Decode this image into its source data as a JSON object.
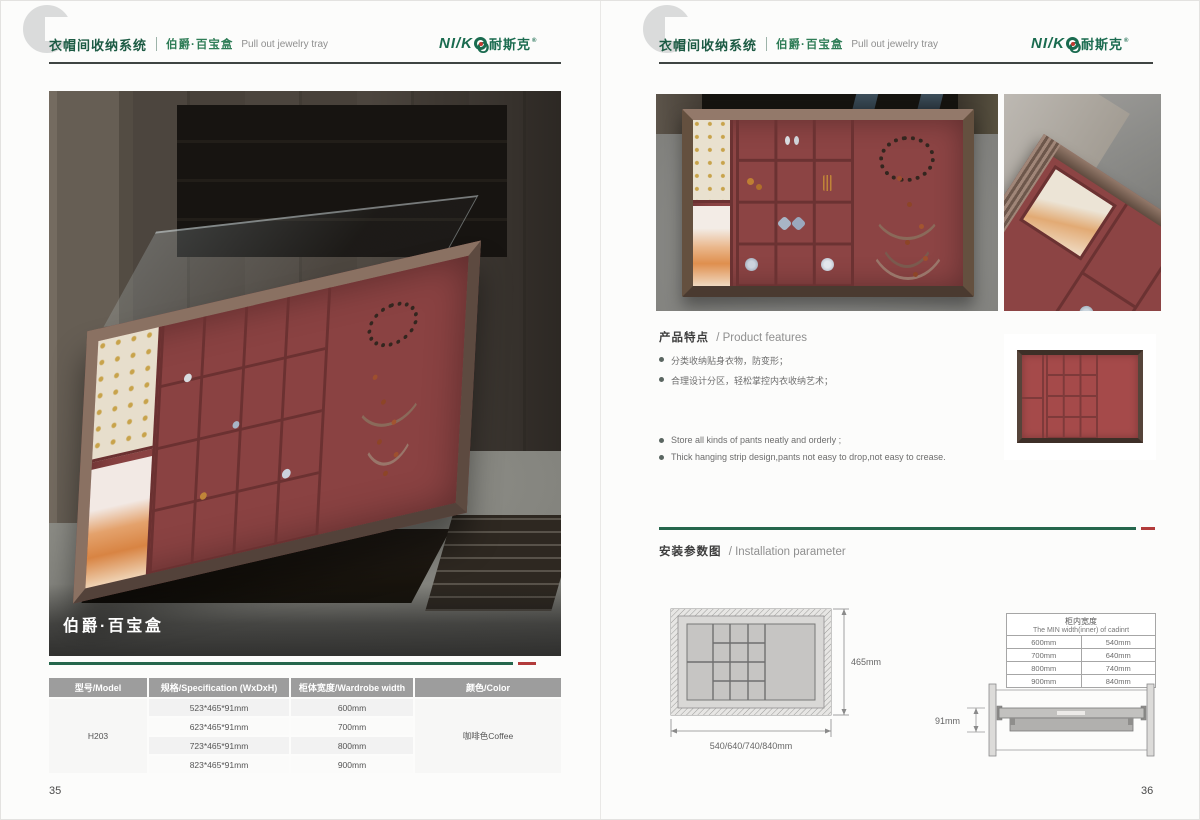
{
  "brand": {
    "logo_prefix": "NI/K",
    "logo_o": "O",
    "logo_suffix": "耐斯克",
    "logo_reg": "®",
    "green": "#1a6b4f",
    "red": "#b23b3b"
  },
  "header": {
    "watermark_letter": "C",
    "system_title": "衣帽间收纳系统",
    "series_name": "伯爵·百宝盒",
    "series_name_en": "Pull out jewelry tray"
  },
  "left_page": {
    "photo_title": "伯爵·百宝盒",
    "page_number": "35",
    "table": {
      "headers": [
        "型号/Model",
        "规格/Specification (WxDxH)",
        "柜体宽度/Wardrobe width",
        "颜色/Color"
      ],
      "model": "H203",
      "color": "咖啡色Coffee",
      "rows": [
        {
          "spec": "523*465*91mm",
          "width": "600mm"
        },
        {
          "spec": "623*465*91mm",
          "width": "700mm"
        },
        {
          "spec": "723*465*91mm",
          "width": "800mm"
        },
        {
          "spec": "823*465*91mm",
          "width": "900mm"
        }
      ]
    }
  },
  "right_page": {
    "page_number": "36",
    "features": {
      "title_zh": "产品特点",
      "title_en": "/ Product features",
      "bullets_zh": [
        "分类收纳贴身衣物，防变形；",
        "合理设计分区，轻松掌控内衣收纳艺术；"
      ],
      "bullets_en": [
        "Store all kinds of pants neatly and orderly ;",
        "Thick hanging strip design,pants not easy to drop,not easy to crease."
      ]
    },
    "installation": {
      "title_zh": "安装参数图",
      "title_en": "/ Installation parameter",
      "top_view": {
        "depth_label": "465mm",
        "width_label": "540/640/740/840mm"
      },
      "side_view": {
        "height_label": "91mm"
      },
      "width_table": {
        "title_zh": "柜内宽度",
        "title_en": "The MIN width(inner) of cadinrt",
        "rows": [
          {
            "cabinet": "600mm",
            "inner": "540mm"
          },
          {
            "cabinet": "700mm",
            "inner": "640mm"
          },
          {
            "cabinet": "800mm",
            "inner": "740mm"
          },
          {
            "cabinet": "900mm",
            "inner": "840mm"
          }
        ]
      }
    }
  }
}
